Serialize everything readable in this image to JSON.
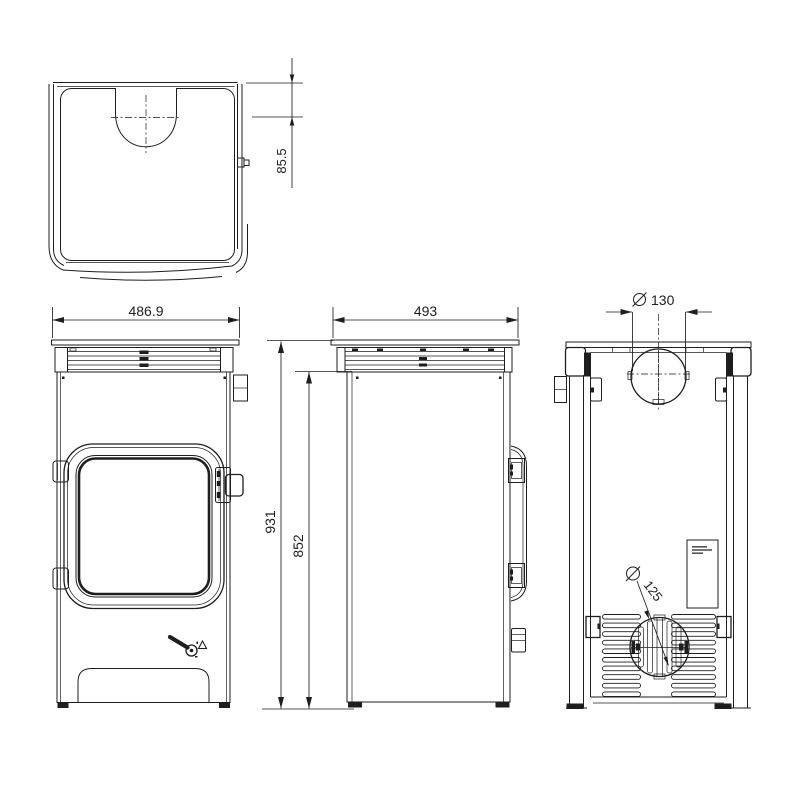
{
  "drawing": {
    "background_color": "#ffffff",
    "line_color": "#1e1e1e",
    "dims": {
      "diameter_symbol": "⌀",
      "flue_center_offset": "85.5",
      "front_width": "486.9",
      "depth": "493",
      "overall_height": "931",
      "body_height": "852",
      "flue_diameter": "130",
      "air_intake_diameter": "125"
    }
  }
}
